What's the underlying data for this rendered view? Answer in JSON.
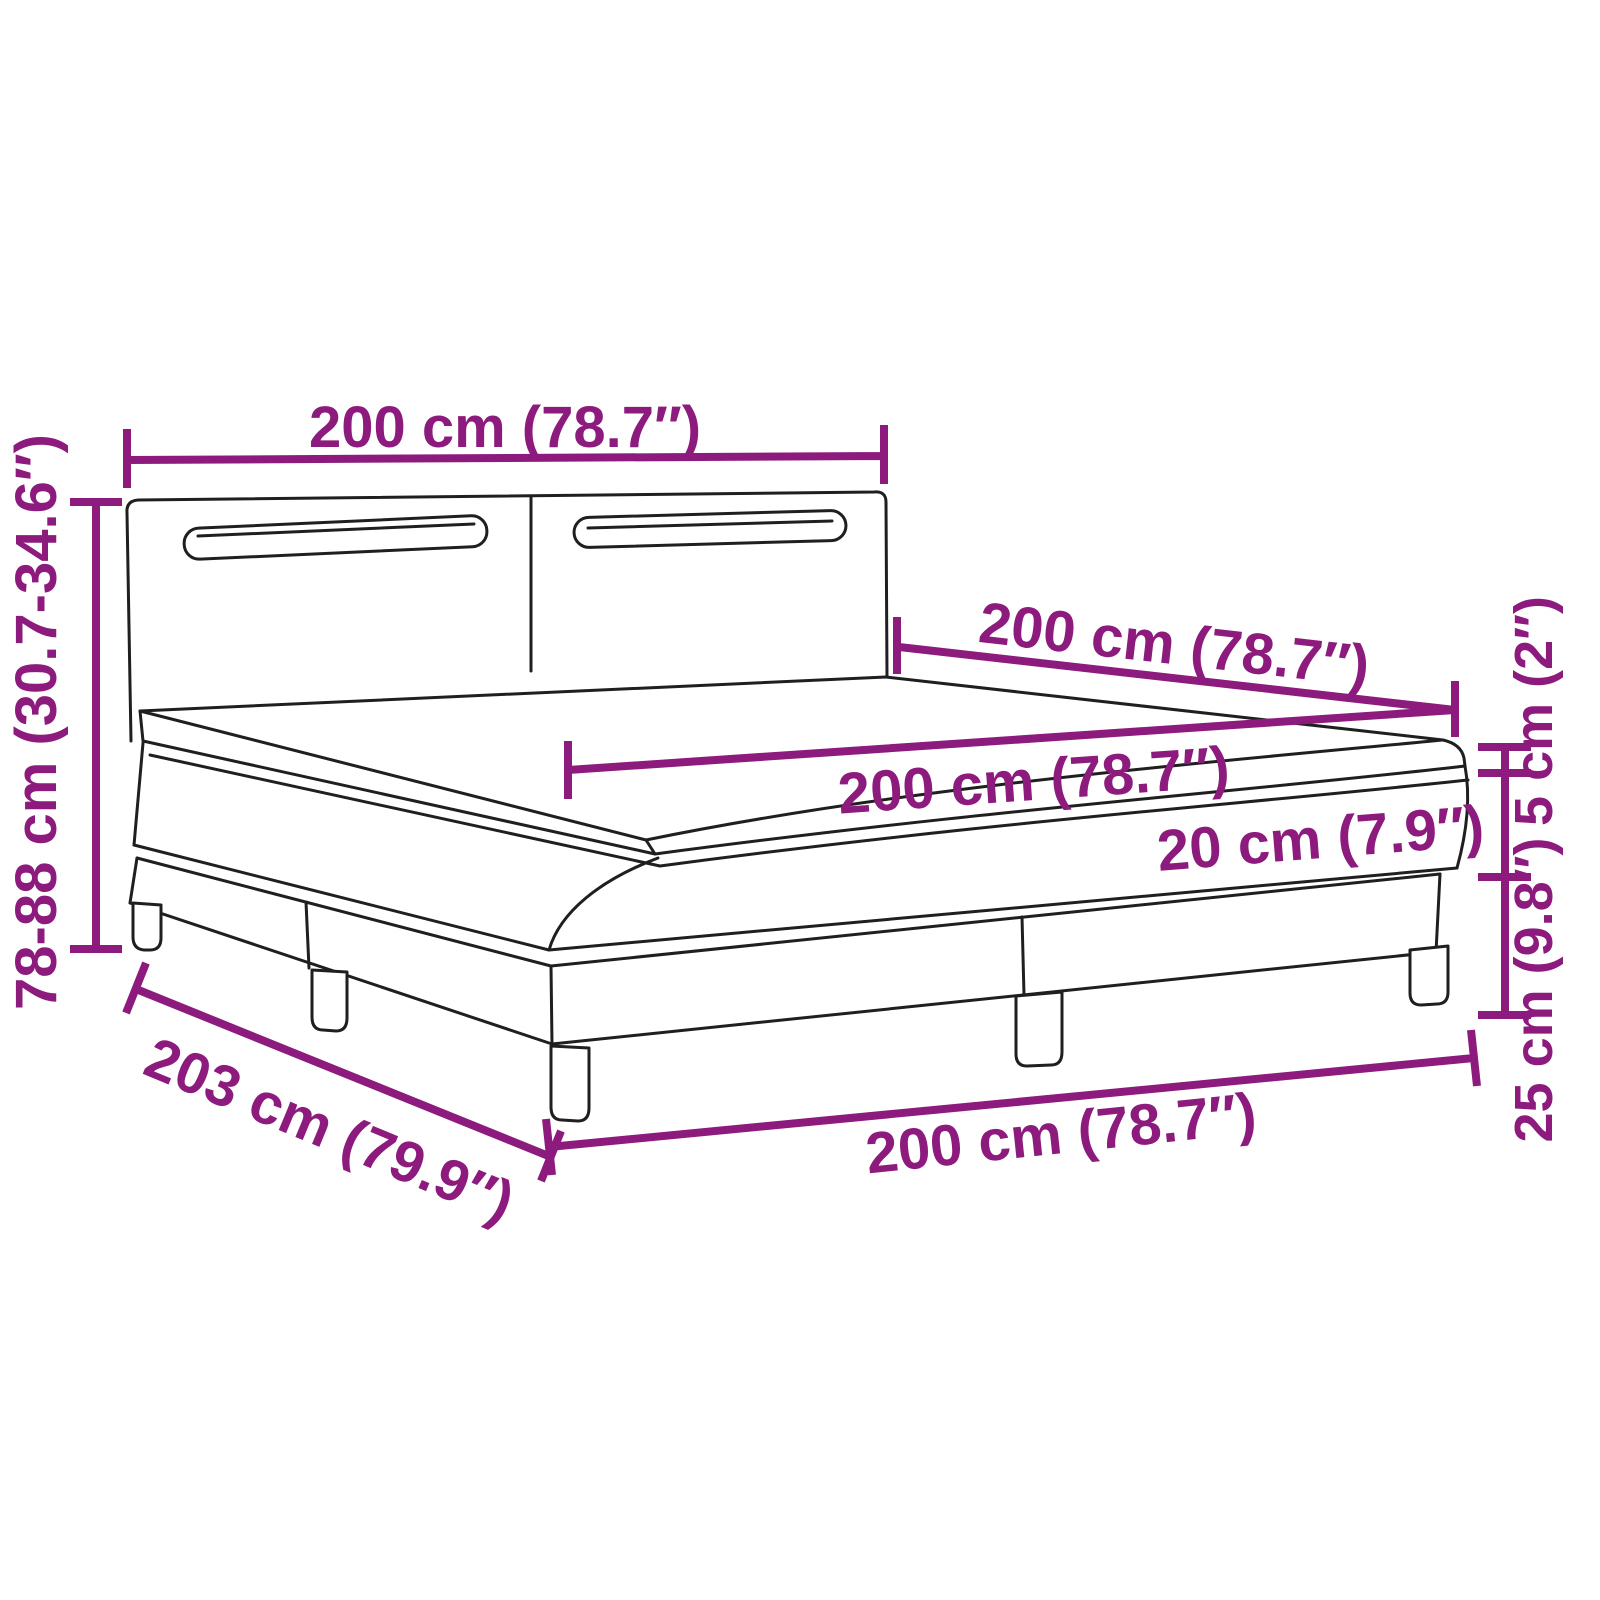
{
  "diagram": {
    "subject": "box-spring-bed-with-led-headboard-dimension-diagram",
    "colors": {
      "dimension": "#8c1b7d",
      "outline": "#1f1f1f",
      "background": "#ffffff"
    },
    "dimensions": {
      "headboard_width": "200 cm (78.7″)",
      "total_height": "78-88 cm (30.7-34.6″)",
      "bed_length": "200 cm (78.7″)",
      "mattress_length": "200 cm (78.7″)",
      "mattress_thickness": "20 cm (7.9″)",
      "topper_thickness": "5 cm (2″)",
      "base_height": "25 cm (9.8″)",
      "frame_length": "203 cm (79.9″)",
      "frame_width": "200 cm (78.7″)"
    }
  }
}
